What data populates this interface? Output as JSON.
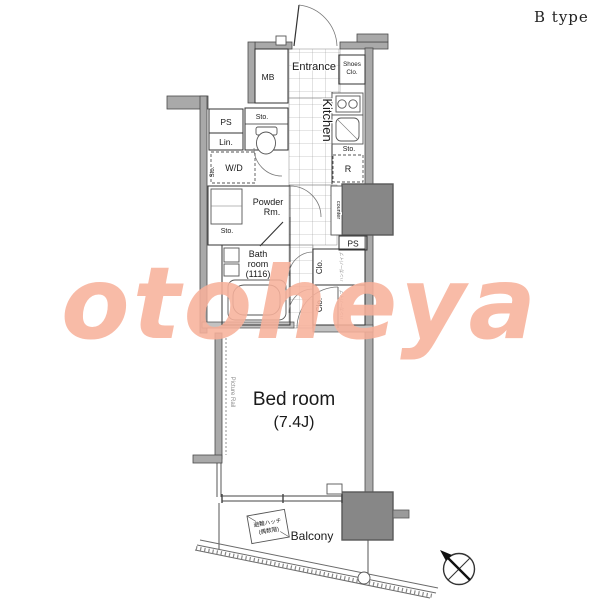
{
  "header": {
    "plan_type": "B type"
  },
  "watermark": {
    "text": "otoheya",
    "color": "#f8b19b"
  },
  "colors": {
    "wall": "#a9a9a9",
    "pillar": "#878787",
    "line": "#333333"
  },
  "rooms": {
    "entrance": "Entrance",
    "shoes_closet": {
      "line1": "Shoes",
      "line2": "Clo."
    },
    "meter_box": "MB",
    "kitchen": "Kitchen",
    "refrigerator": "R",
    "pipe_space": "PS",
    "linen": "Lin.",
    "washer_dryer": "W/D",
    "powder_room": {
      "line1": "Powder",
      "line2": "Rm."
    },
    "bath_room": {
      "line1": "Bath",
      "line2": "room",
      "line3": "(1116)"
    },
    "bed_room": {
      "name": "Bed room",
      "size": "(7.4J)"
    },
    "balcony": "Balcony",
    "closet": "Clo.",
    "storage": "Sto.",
    "counter": "counter",
    "picture_rail": "Picture Rail",
    "closet_note": "ハンガーパイプ"
  },
  "balcony_hatch": {
    "line1": "避難ハッチ",
    "line2": "(偶数階)"
  },
  "icons": {
    "compass": "north-compass-icon"
  }
}
